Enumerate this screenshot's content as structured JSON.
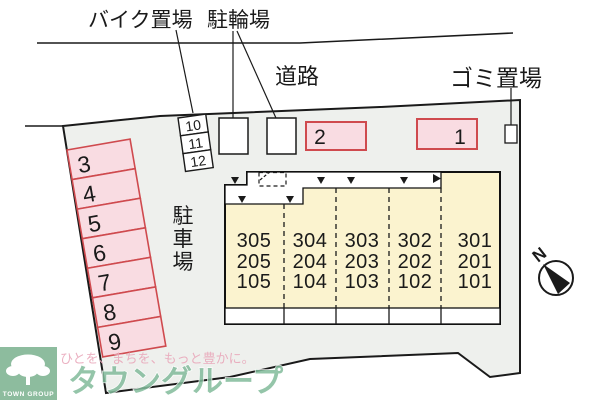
{
  "map": {
    "labels": {
      "bike_parking": "バイク置場",
      "bicycle_parking": "駐輪場",
      "road": "道路",
      "garbage": "ゴミ置場",
      "car_parking_chars": [
        "駐",
        "車",
        "場"
      ],
      "north": "N"
    },
    "parking_stalls": [
      "3",
      "4",
      "5",
      "6",
      "7",
      "8",
      "9"
    ],
    "small_stalls": [
      "10",
      "11",
      "12"
    ],
    "lots": [
      "2",
      "1"
    ],
    "building": {
      "columns": [
        {
          "rooms": [
            "305",
            "205",
            "105"
          ]
        },
        {
          "rooms": [
            "304",
            "204",
            "104"
          ]
        },
        {
          "rooms": [
            "303",
            "203",
            "103"
          ]
        },
        {
          "rooms": [
            "302",
            "202",
            "102"
          ]
        },
        {
          "rooms": [
            "301",
            "201",
            "101"
          ]
        }
      ]
    },
    "colors": {
      "background_gray": "#eef0ed",
      "building_cream": "#fbf3cf",
      "stall_pink": "#f9dce2",
      "stall_red": "#cf4a4e",
      "line_black": "#1a1a1a",
      "brand_green": "#8dbc9e",
      "tagline_pink": "#e9a8bb"
    }
  },
  "watermark": {
    "tagline": "ひとを、まちを、もっと豊かに。",
    "brand": "タウングループ",
    "logo_text": "TOWN GROUP"
  }
}
